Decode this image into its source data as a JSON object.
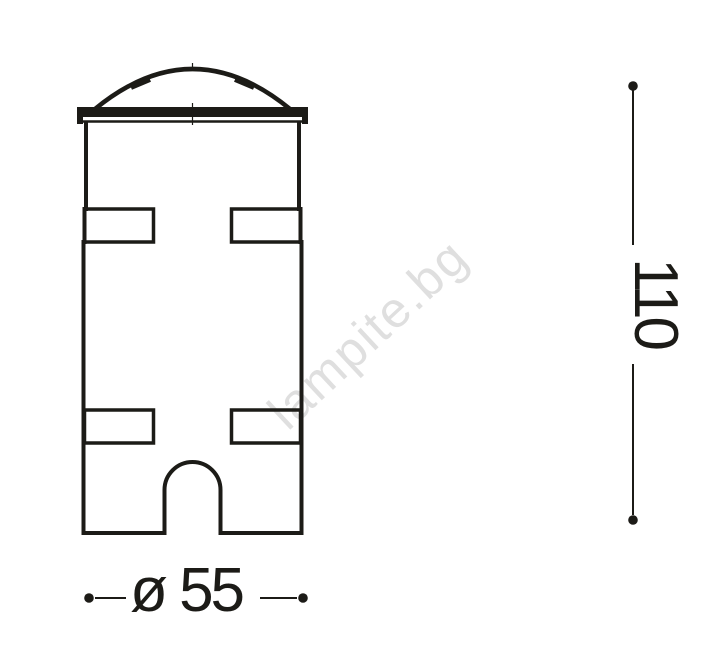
{
  "watermark": {
    "text": "lampite.bg",
    "color": "#dfdfdf"
  },
  "dimensions": {
    "height": {
      "label": "110"
    },
    "diameter": {
      "label": "ø 55"
    }
  },
  "colors": {
    "line": "#1c1b17",
    "background": "#ffffff"
  }
}
